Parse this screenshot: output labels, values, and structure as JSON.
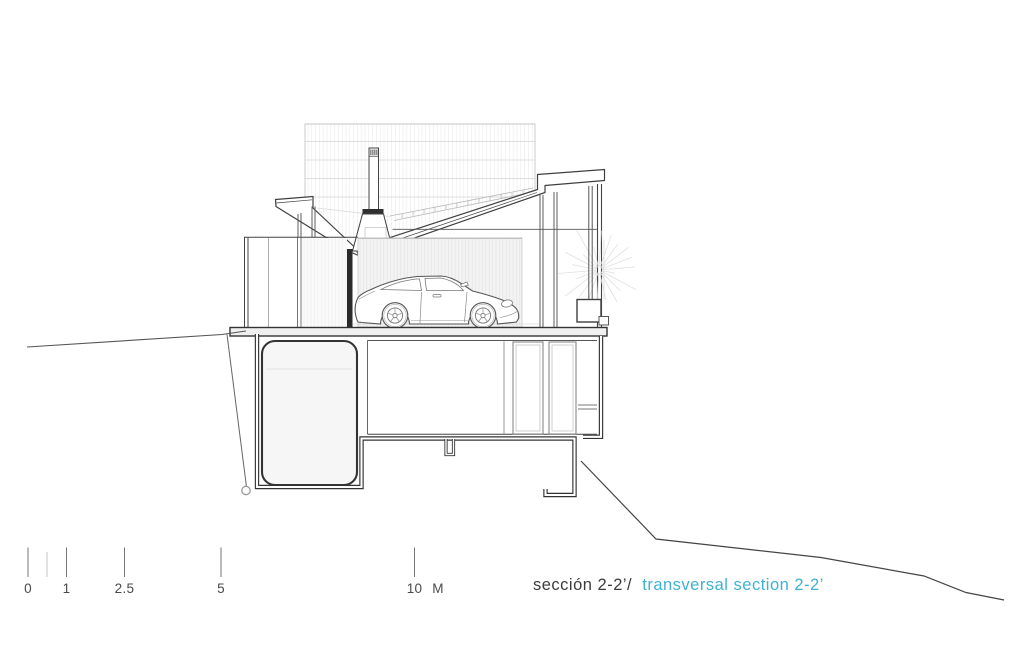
{
  "drawing": {
    "title": {
      "primary": "sección 2-2’/",
      "secondary": "transversal section 2-2’",
      "primary_color": "#3c3c3c",
      "secondary_color": "#3fb2d4"
    },
    "scale_bar": {
      "labels": [
        "0",
        "1",
        "2.5",
        "5",
        "10"
      ],
      "unit": "M",
      "color": "#4a4a4a"
    },
    "ink_color": "#3f3f3f",
    "elements": {
      "vehicle": "porsche-911-coupe-side-view",
      "screen": "louvered-grid-panel",
      "roof": "butterfly-roof-section",
      "fireplace": "chimney-flue-and-hood",
      "vegetation": "grass-starburst",
      "levels": [
        "garage-level",
        "basement-level"
      ]
    }
  }
}
